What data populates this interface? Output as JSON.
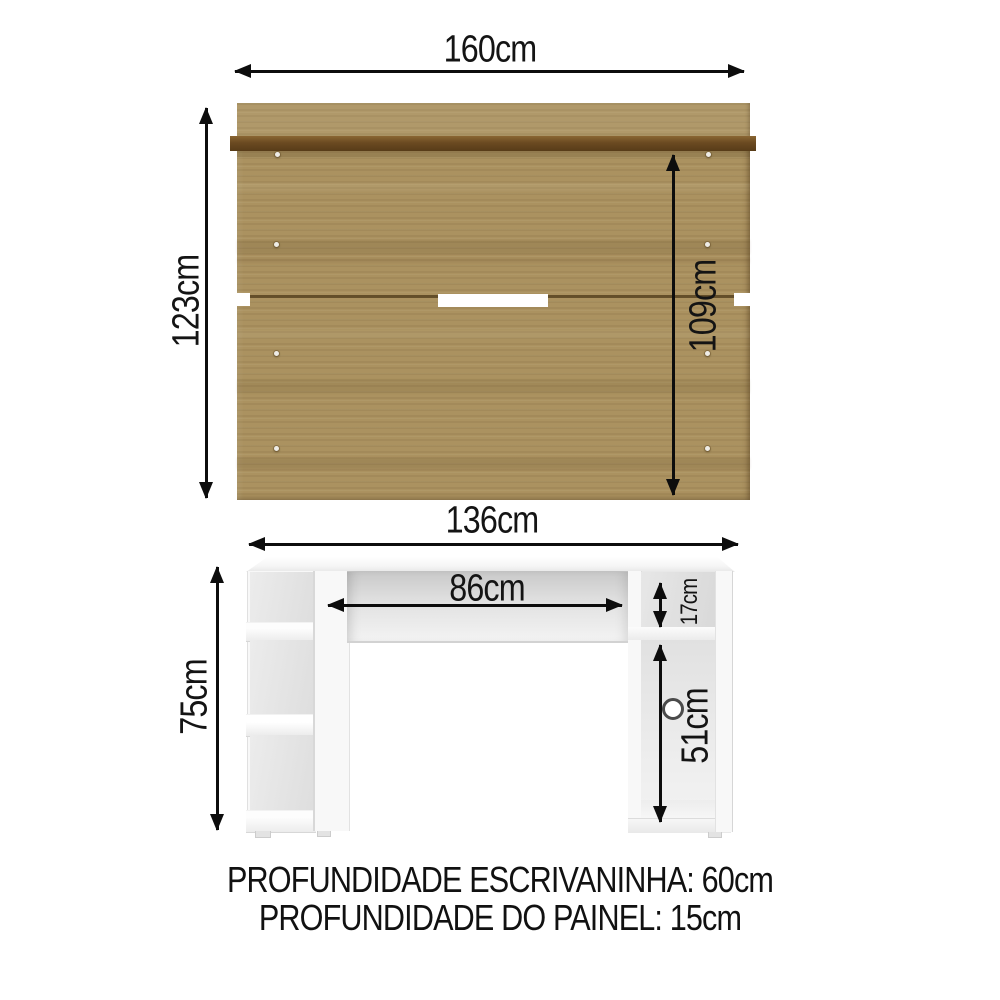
{
  "panel": {
    "width_label": "160cm",
    "height_label": "123cm",
    "inner_height_label": "109cm"
  },
  "desk": {
    "width_label": "136cm",
    "height_label": "75cm",
    "inner_width_label": "86cm",
    "shelf_height_label": "17cm",
    "opening_height_label": "51cm"
  },
  "notes": {
    "line1": "PROFUNDIDADE ESCRIVANINHA: 60cm",
    "line2": "PROFUNDIDADE DO PAINEL: 15cm"
  },
  "colors": {
    "wood": "#ab9260",
    "wood_edge": "#6b4a21",
    "furniture_white": "#f8f8f8",
    "annotation": "#0d0d0d"
  }
}
